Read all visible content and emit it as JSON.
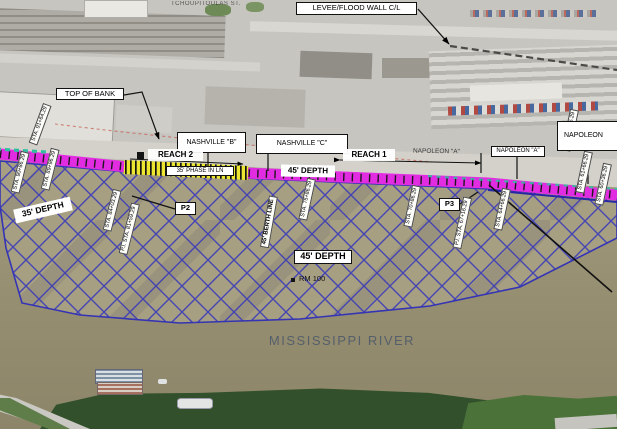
{
  "colors": {
    "wharf_magenta": "#e22ce2",
    "wharf_yellow": "#ece631",
    "dredge_hatch_blue": "#3a3ab8",
    "survey_teal": "#2fbf9f",
    "river_tan": "#9d9578",
    "tree_green": "#31502b",
    "label_text": "#000000",
    "river_name_gray": "#555f6b"
  },
  "aerial": {
    "street_name": "TCHOUPITOULAS ST."
  },
  "labels": {
    "levee": "LEVEE/FLOOD WALL C/L",
    "top_of_bank": "TOP OF BANK",
    "reach2": "REACH 2",
    "reach1": "REACH 1",
    "nashville_b": "NASHVILLE \"B\"",
    "nashville_c": "NASHVILLE \"C\"",
    "napoleon_a": "NAPOLEON \"A\"",
    "napoleon_a_text": "NAPOLEON \"A\"",
    "napoleon_b": "NAPOLEON",
    "depth_35": "35' DEPTH",
    "depth_45_wharf": "45' DEPTH",
    "depth_45_river": "45' DEPTH",
    "phase_in": "35' PHASE IN LN",
    "berth_line": "45' BERTH LINE",
    "p2": "P2",
    "p3": "P3",
    "river_mile": "RM 100",
    "river_name": "MISSISSIPPI RIVER"
  },
  "stations": [
    {
      "text": "STA. 91+64.29"
    },
    {
      "text": "STA. 90+86.29"
    },
    {
      "text": "STA. 89+96.29"
    },
    {
      "text": "STA. 84+03.29"
    },
    {
      "text": "P.I. STA. 81+59.29"
    },
    {
      "text": "STA. 75+86.29"
    },
    {
      "text": "STA. 70+86.29"
    },
    {
      "text": "P.I. STA. 67+16.29"
    },
    {
      "text": "STA. 64+66.29"
    },
    {
      "text": "STA. 63+26.29"
    },
    {
      "text": "STA. 61+66.29"
    },
    {
      "text": "STA. 60+36.29"
    }
  ]
}
